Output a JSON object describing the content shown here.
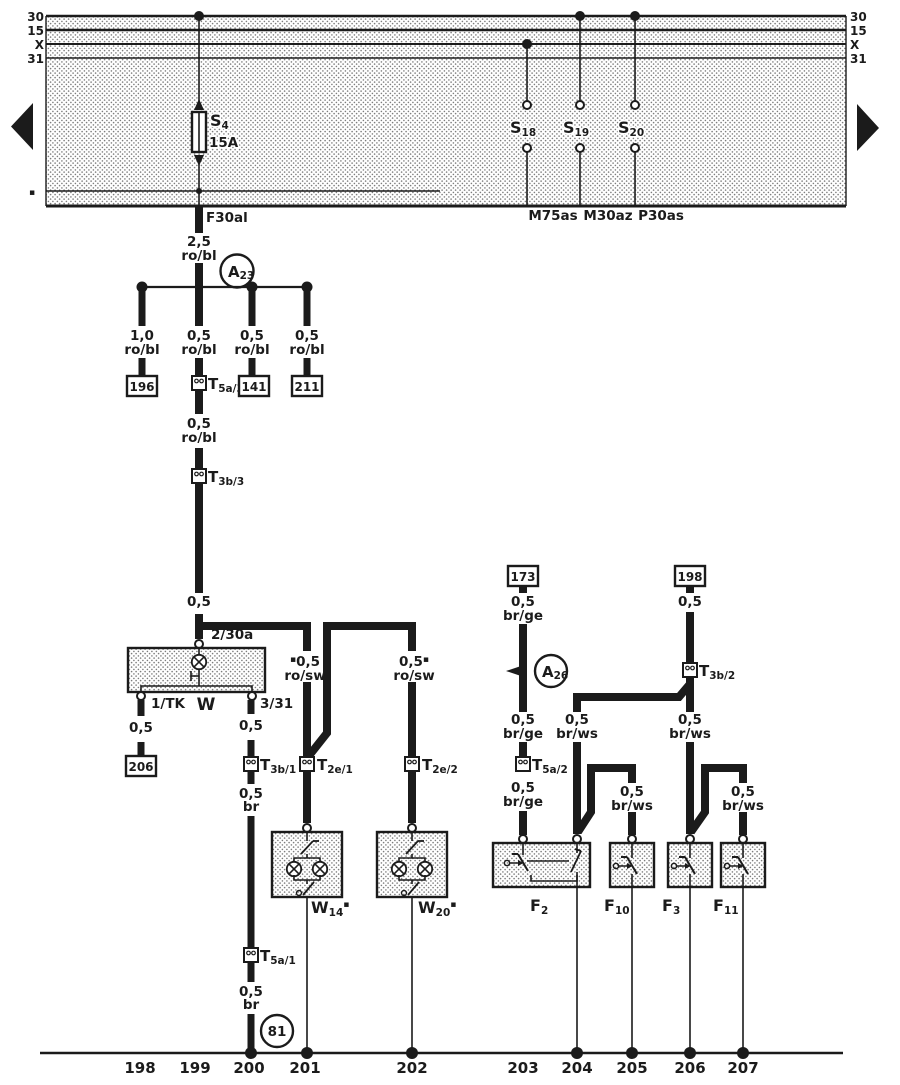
{
  "colors": {
    "ink": "#1b1b1b",
    "paper": "#ffffff"
  },
  "marker": "▪",
  "bus": {
    "left": [
      "30",
      "15",
      "X",
      "31"
    ],
    "right": [
      "30",
      "15",
      "X",
      "31"
    ],
    "edge_marker": "▪"
  },
  "band": {
    "s4": {
      "id": "S",
      "sub": "4",
      "rating": "15A",
      "exit": "F30al"
    },
    "s18": {
      "id": "S",
      "sub": "18",
      "exit": "M75as"
    },
    "s19": {
      "id": "S",
      "sub": "19",
      "exit": "M30az"
    },
    "s20": {
      "id": "S",
      "sub": "20",
      "exit": "P30as"
    }
  },
  "a23": {
    "id": "A",
    "sub": "23"
  },
  "a26": {
    "id": "A",
    "sub": "26"
  },
  "trunk": {
    "gauge": "2,5",
    "color": "ro/bl",
    "seg2_gauge": "0,5",
    "seg2_color": "ro/bl",
    "seg3_gauge": "0,5"
  },
  "branches": {
    "b1": {
      "gauge": "1,0",
      "color": "ro/bl",
      "box": "196"
    },
    "b2": {
      "gauge": "0,5",
      "color": "ro/bl"
    },
    "b3": {
      "gauge": "0,5",
      "color": "ro/bl",
      "box": "141"
    },
    "b4": {
      "gauge": "0,5",
      "color": "ro/bl",
      "box": "211"
    }
  },
  "connectors": {
    "t5a3": {
      "id": "T",
      "sub": "5a/3"
    },
    "t3b3": {
      "id": "T",
      "sub": "3b/3"
    },
    "t3b1": {
      "id": "T",
      "sub": "3b/1"
    },
    "t5a1": {
      "id": "T",
      "sub": "5a/1"
    },
    "t5a2": {
      "id": "T",
      "sub": "5a/2"
    },
    "t3b2": {
      "id": "T",
      "sub": "3b/2"
    },
    "t2e1": {
      "id": "T",
      "sub": "2e/1"
    },
    "t2e2": {
      "id": "T",
      "sub": "2e/2"
    }
  },
  "w": {
    "label": "W",
    "top": "2/30a",
    "left": "1/TK",
    "right": "3/31",
    "left_gauge": "0,5",
    "left_box": "206",
    "right_gauge": "0,5",
    "br1_gauge": "0,5",
    "br1_color": "br",
    "br2_gauge": "0,5",
    "br2_color": "br"
  },
  "ground": {
    "label": "81"
  },
  "lamps": {
    "left": {
      "gauge": "0,5",
      "color": "ro/sw",
      "id": "W",
      "sub": "14"
    },
    "right": {
      "gauge": "0,5",
      "color": "ro/sw",
      "id": "W",
      "sub": "20"
    }
  },
  "right": {
    "box173": "173",
    "box198": "198",
    "c173_1g": "0,5",
    "c173_1c": "br/ge",
    "c173_2g": "0,5",
    "c173_2c": "br/ge",
    "c173_3g": "0,5",
    "c173_3c": "br/ge",
    "c198_1g": "0,5",
    "f2r_g": "0,5",
    "f2r_c": "br/ws",
    "f3_g": "0,5",
    "f3_c": "br/ws",
    "f10_g": "0,5",
    "f10_c": "br/ws",
    "f11_g": "0,5",
    "f11_c": "br/ws",
    "f2": {
      "id": "F",
      "sub": "2"
    },
    "f10": {
      "id": "F",
      "sub": "10"
    },
    "f3": {
      "id": "F",
      "sub": "3"
    },
    "f11": {
      "id": "F",
      "sub": "11"
    }
  },
  "tracks": [
    "198",
    "199",
    "200",
    "201",
    "202",
    "203",
    "204",
    "205",
    "206",
    "207"
  ]
}
